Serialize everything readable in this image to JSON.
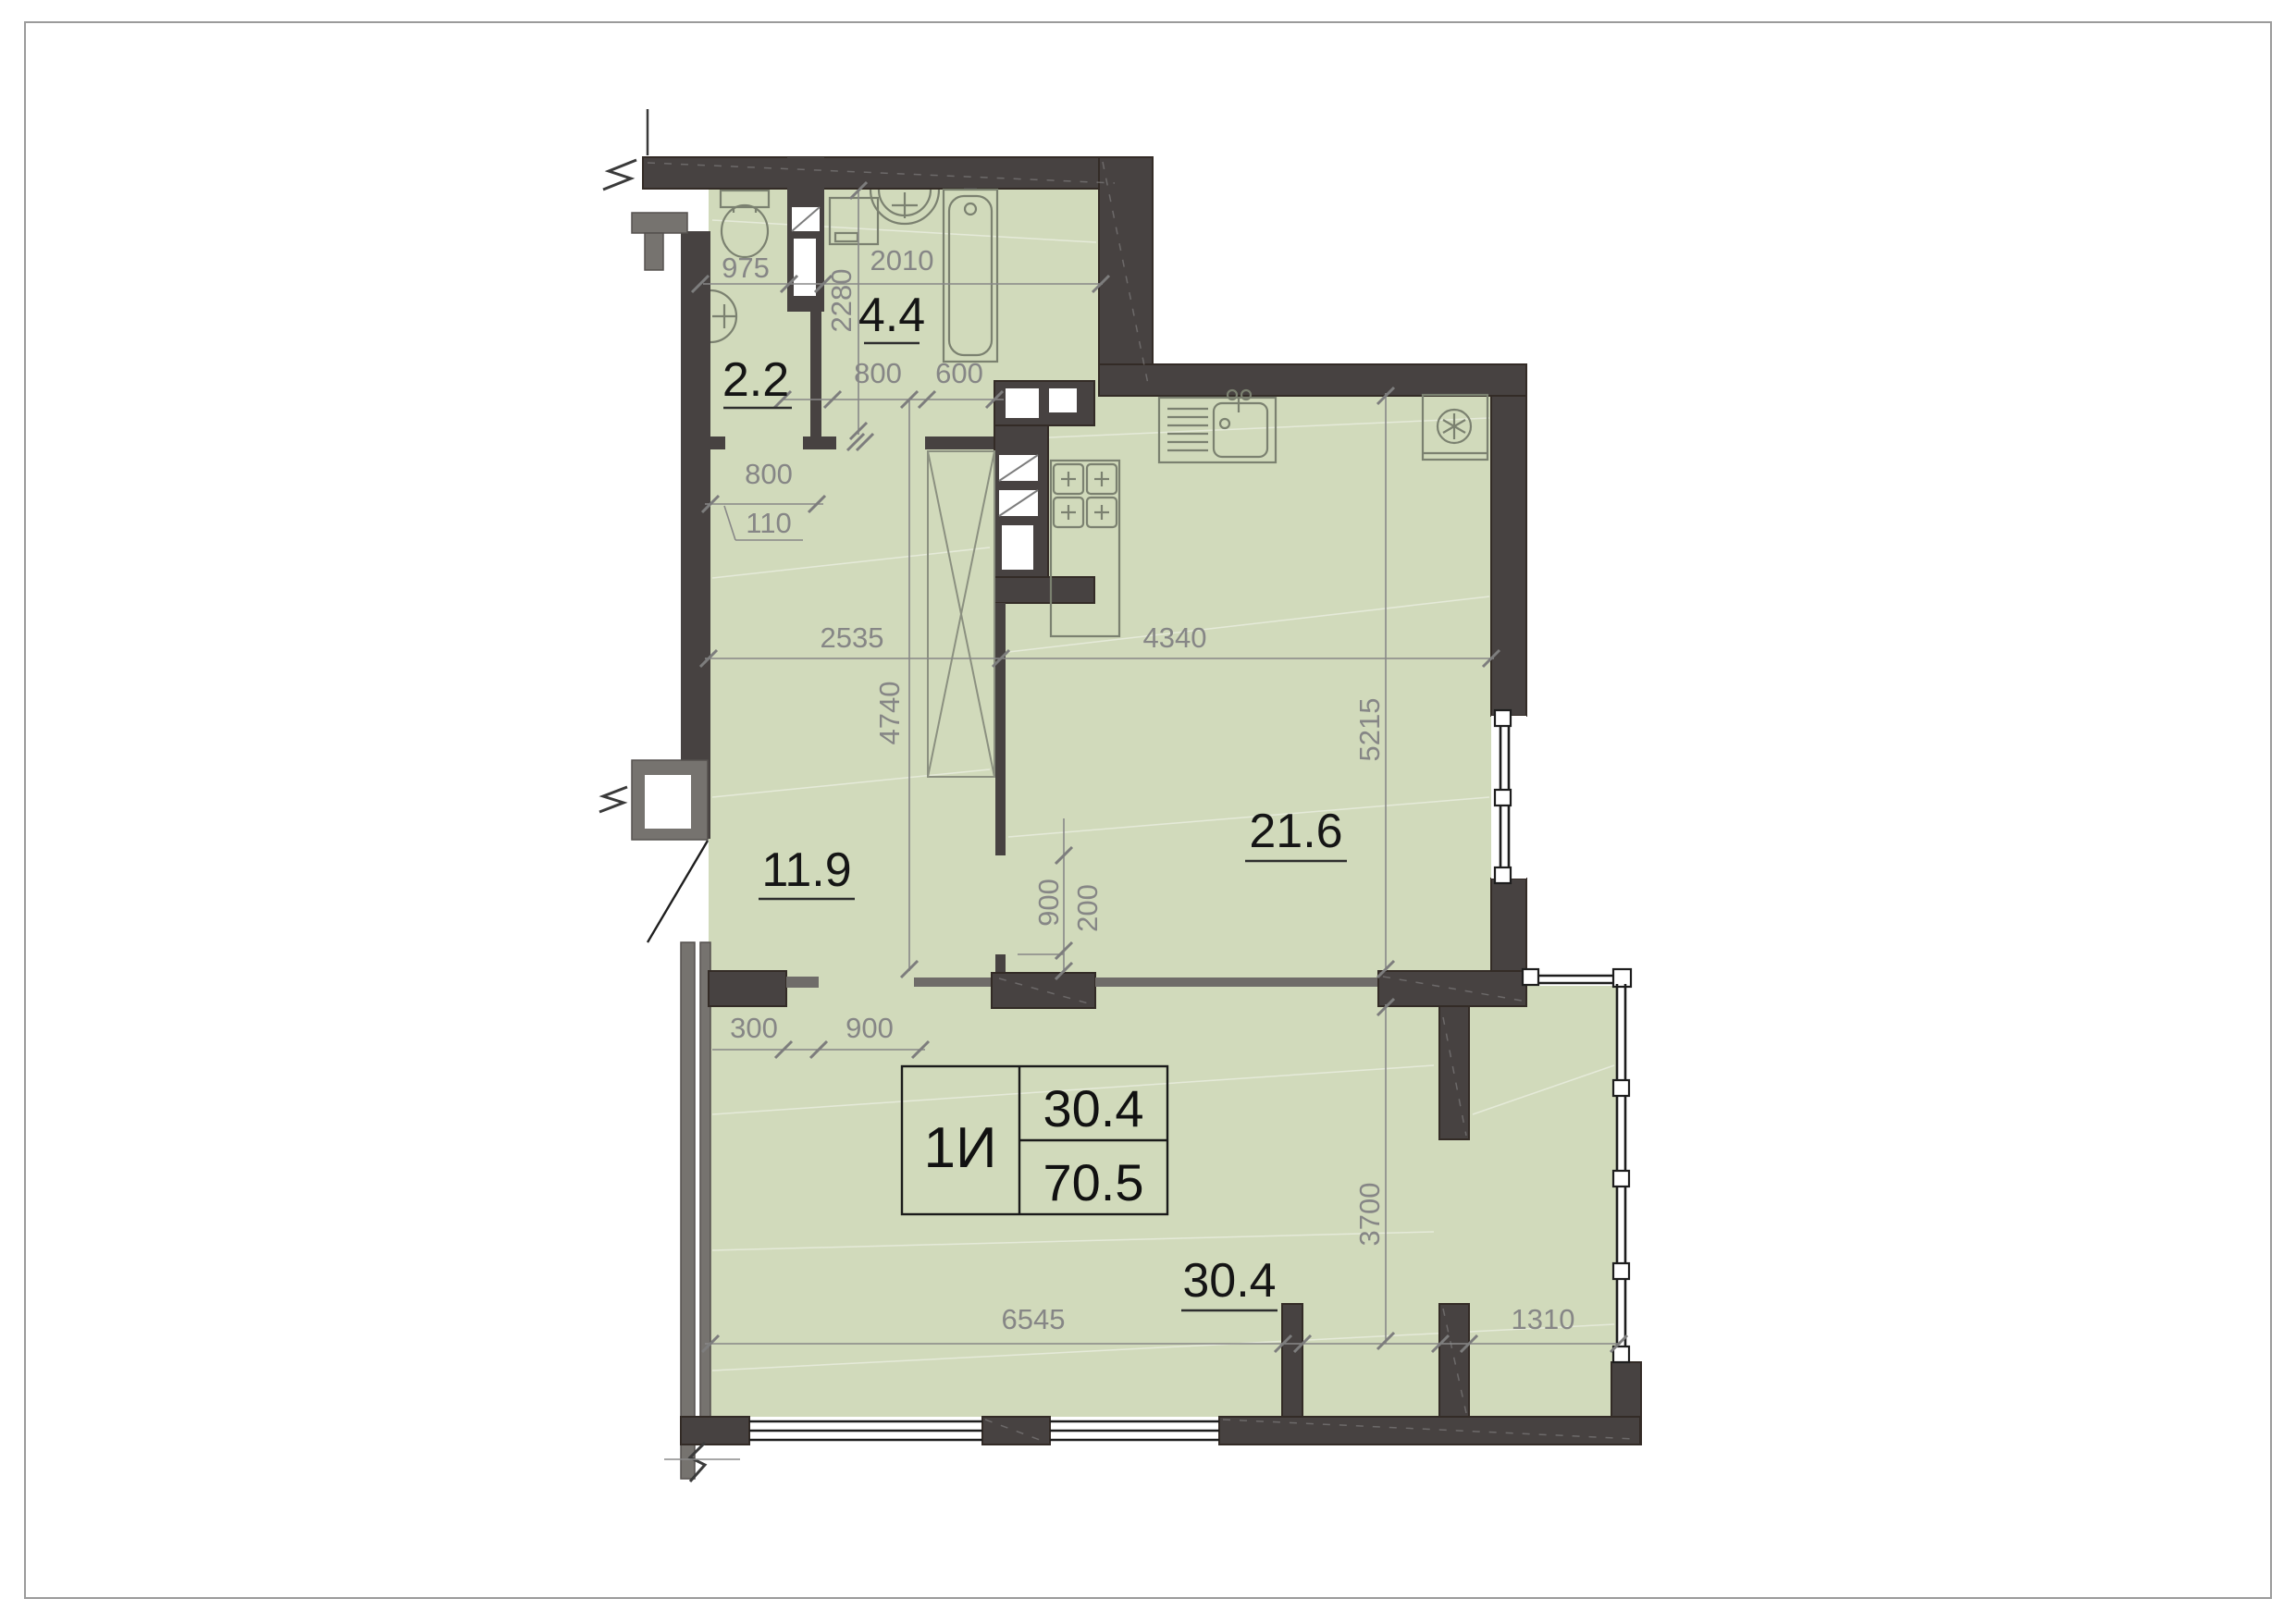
{
  "document": {
    "kind": "apartment floor plan"
  },
  "title_block": {
    "unit_type": "1И",
    "living_area": "30.4",
    "total_area": "70.5"
  },
  "rooms": [
    {
      "name": "wc",
      "area_label": "2.2"
    },
    {
      "name": "bathroom",
      "area_label": "4.4"
    },
    {
      "name": "hallway",
      "area_label": "11.9"
    },
    {
      "name": "kitchen-living-room",
      "area_label": "21.6"
    },
    {
      "name": "living-room",
      "area_label": "30.4"
    }
  ],
  "dimensions_mm": {
    "wc_width": "975",
    "bathroom_width": "2010",
    "bathroom_depth": "2280",
    "bathroom_door": "800",
    "duct_width": "600",
    "wc_door": "800",
    "wc_door_offset": "110",
    "hallway_width": "2535",
    "hallway_depth": "4740",
    "kitchen_width": "4340",
    "kitchen_depth": "5215",
    "kitchen_passage": "900",
    "kitchen_passage_offset": "200",
    "room_passage_offset": "300",
    "room_passage": "900",
    "room_width": "6545",
    "room_depth": "3700",
    "balcony_width": "1310"
  },
  "colors": {
    "background": "#ffffff",
    "floor_fill": "#d1dabb",
    "wall_dark": "#474241",
    "wall_gray": "#76736f",
    "dimension_text": "#868686",
    "area_text": "#151515"
  },
  "icons": [
    "toilet-icon",
    "sink-icon",
    "washing-machine-icon",
    "bathtub-icon",
    "kitchen-sink-icon",
    "stove-icon",
    "fridge-snowflake-icon",
    "wardrobe",
    "door-swing"
  ]
}
